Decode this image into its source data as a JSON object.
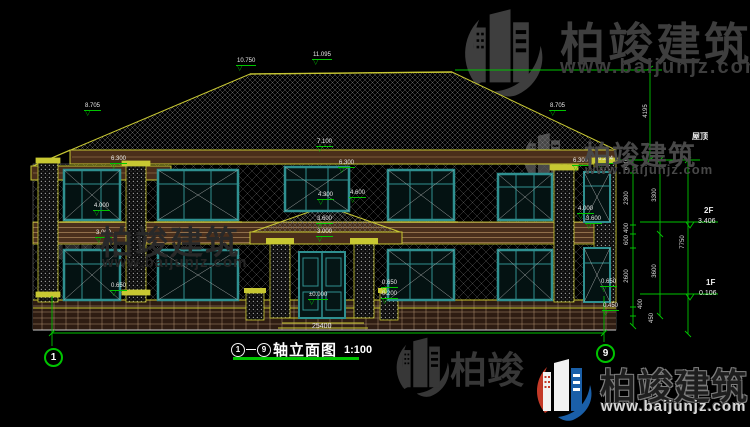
{
  "meta": {
    "background": "#000000",
    "dimension_green": "#00c400",
    "outline_yellow": "#c8c832",
    "window_teal": "#2f9090",
    "logo_red": "#c43a28",
    "logo_blue": "#1a5fa8"
  },
  "title": {
    "axis_from": "1",
    "dash": "—",
    "axis_to": "9",
    "text": "轴立面图",
    "scale": "1:100"
  },
  "axis_bubbles": {
    "left": "1",
    "right": "9"
  },
  "levels": {
    "ridge_left": "10.750",
    "ridge_main": "11.095",
    "roof_break_left": "8.705",
    "roof_break_right": "8.705",
    "eave_center": "7.100",
    "eave_left": "6.300",
    "eave_mid": "6.300",
    "eave_right": "6.300",
    "parapet_right": "6.224",
    "sill2_left": "4.300",
    "sill2_right": "4.600",
    "band_top_left": "4.000",
    "band_bottom_left": "3.000",
    "band_top_right": "4.000",
    "band_bottom_right": "3.600",
    "porch_roof": "3.600",
    "porch_beam": "3.000",
    "ground": "±0.000",
    "planter_left": "0.650",
    "planter_right_top": "0.650",
    "planter_right_bottom": "0.200",
    "edge_upper": "0.650",
    "edge_lower": "0.450"
  },
  "dims": {
    "total_width": "25400",
    "roof_height": "4195",
    "total_right": "7750",
    "inner": [
      "600",
      "2300",
      "400",
      "600",
      "2600",
      "400",
      "450"
    ],
    "mid": [
      "3300",
      "3600"
    ],
    "roof_label": "屋顶",
    "floor2": "2F",
    "floor2_level": "3.406",
    "floor1": "1F",
    "floor1_level": "0.106"
  },
  "watermark": {
    "brand": "柏竣建筑",
    "brand_partial": "柏竣",
    "url": "www.baijunjz.com"
  }
}
